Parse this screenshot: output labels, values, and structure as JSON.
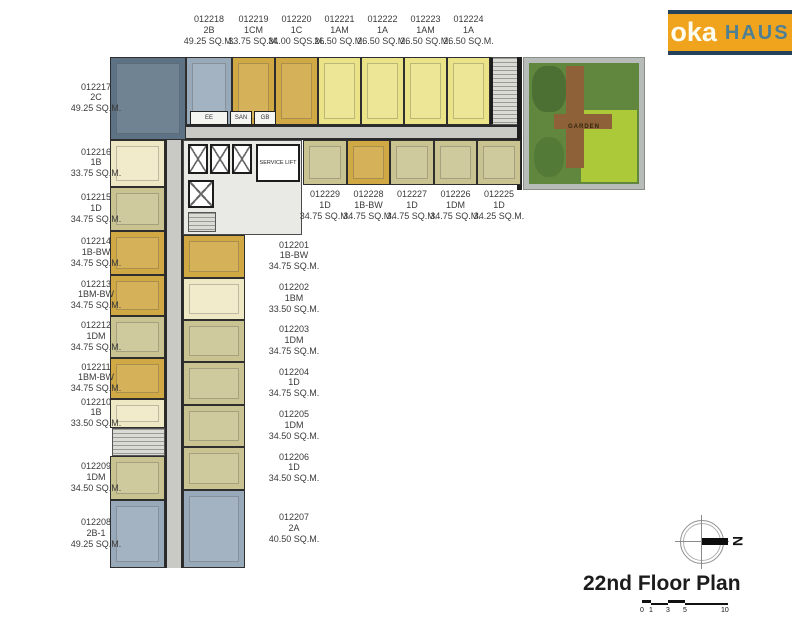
{
  "logo": {
    "brand_primary": "oka",
    "brand_secondary": "HAUS"
  },
  "plan": {
    "title": "22nd Floor Plan"
  },
  "compass": {
    "letter": "N"
  },
  "scale_bar": {
    "ticks": [
      "0",
      "1",
      "3",
      "5",
      "10"
    ]
  },
  "core": {
    "rooms": [
      "EE",
      "SAN",
      "GB"
    ],
    "service_lift_label": "SERVICE LIFT"
  },
  "garden": {
    "label": "GARDEN"
  },
  "colors": {
    "mustard": "#d0a844",
    "pale_yellow": "#eae388",
    "cream": "#efe8c4",
    "khaki": "#c9c391",
    "blue_gray": "#98a9b9",
    "dark_blue": "#5d7284",
    "corridor": "#c9c9c5",
    "logo_orange": "#f0a41e",
    "logo_navy": "#24435a",
    "logo_haus": "#4f7f93",
    "garden_green": "#61873f",
    "garden_lawn": "#abc938",
    "garden_deck": "#8f6138"
  },
  "units": {
    "top_row": [
      {
        "id": "012218",
        "type": "2B",
        "area": "49.25 SQ.M."
      },
      {
        "id": "012219",
        "type": "1CM",
        "area": "33.75 SQ.M."
      },
      {
        "id": "012220",
        "type": "1C",
        "area": "34.00 SQS.M."
      },
      {
        "id": "012221",
        "type": "1AM",
        "area": "26.50 SQ.M."
      },
      {
        "id": "012222",
        "type": "1A",
        "area": "26.50 SQ.M."
      },
      {
        "id": "012223",
        "type": "1AM",
        "area": "26.50 SQ.M."
      },
      {
        "id": "012224",
        "type": "1A",
        "area": "26.50 SQ.M."
      }
    ],
    "mid_row": [
      {
        "id": "012229",
        "type": "1D",
        "area": "34.75 SQ.M."
      },
      {
        "id": "012228",
        "type": "1B-BW",
        "area": "34.75 SQ.M."
      },
      {
        "id": "012227",
        "type": "1D",
        "area": "34.75 SQ.M."
      },
      {
        "id": "012226",
        "type": "1DM",
        "area": "34.75 SQ.M."
      },
      {
        "id": "012225",
        "type": "1D",
        "area": "34.25 SQ.M."
      }
    ],
    "left_col": [
      {
        "id": "012217",
        "type": "2C",
        "area": "49.25 SQ.M."
      },
      {
        "id": "012216",
        "type": "1B",
        "area": "33.75 SQ.M."
      },
      {
        "id": "012215",
        "type": "1D",
        "area": "34.75 SQ.M."
      },
      {
        "id": "012214",
        "type": "1B-BW",
        "area": "34.75 SQ.M."
      },
      {
        "id": "012213",
        "type": "1BM-BW",
        "area": "34.75 SQ.M."
      },
      {
        "id": "012212",
        "type": "1DM",
        "area": "34.75 SQ.M."
      },
      {
        "id": "012211",
        "type": "1BM-BW",
        "area": "34.75 SQ.M."
      },
      {
        "id": "012210",
        "type": "1B",
        "area": "33.50 SQ.M."
      },
      {
        "id": "012209",
        "type": "1DM",
        "area": "34.50 SQ.M."
      },
      {
        "id": "012208",
        "type": "2B-1",
        "area": "49.25 SQ.M."
      }
    ],
    "center_col": [
      {
        "id": "012201",
        "type": "1B-BW",
        "area": "34.75 SQ.M."
      },
      {
        "id": "012202",
        "type": "1BM",
        "area": "33.50 SQ.M."
      },
      {
        "id": "012203",
        "type": "1DM",
        "area": "34.75 SQ.M."
      },
      {
        "id": "012204",
        "type": "1D",
        "area": "34.75 SQ.M."
      },
      {
        "id": "012205",
        "type": "1DM",
        "area": "34.50 SQ.M."
      },
      {
        "id": "012206",
        "type": "1D",
        "area": "34.50 SQ.M."
      },
      {
        "id": "012207",
        "type": "2A",
        "area": "40.50 SQ.M."
      }
    ]
  }
}
